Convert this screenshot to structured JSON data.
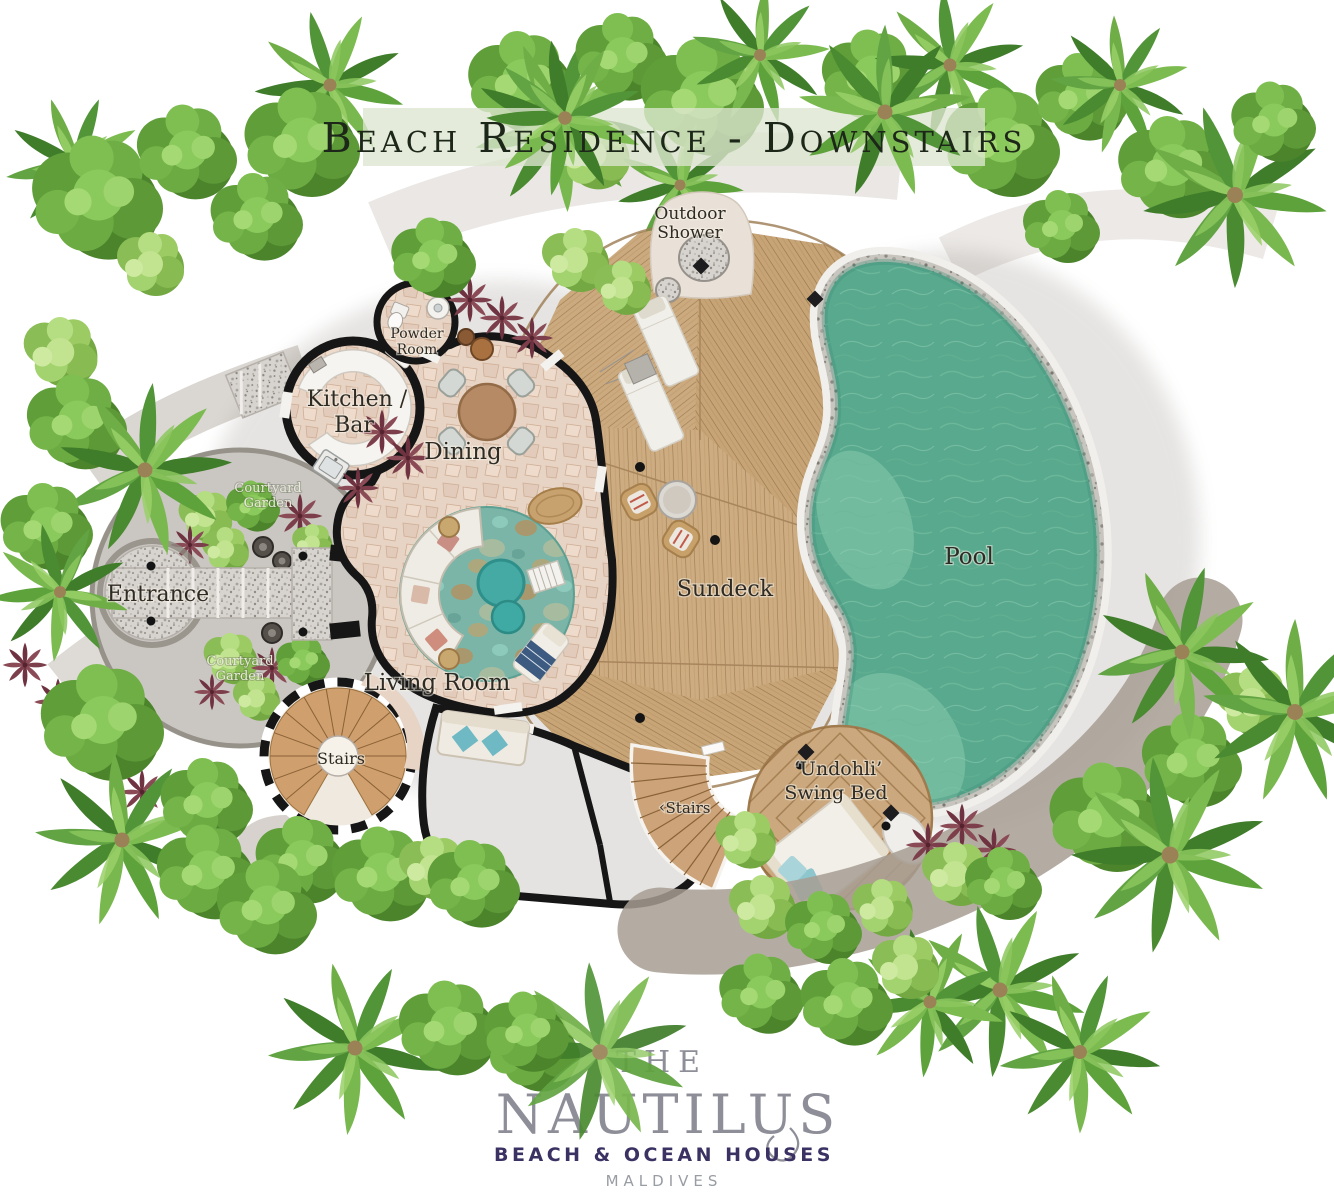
{
  "title": "Beach Residence - Downstairs",
  "labels": {
    "outdoor_shower_1": "Outdoor",
    "outdoor_shower_2": "Shower",
    "powder_room_1": "Powder",
    "powder_room_2": "Room",
    "kitchen_bar_1": "Kitchen /",
    "kitchen_bar_2": "Bar",
    "dining": "Dining",
    "courtyard_upper_1": "Courtyard",
    "courtyard_upper_2": "Garden",
    "entrance": "Entrance",
    "courtyard_lower_1": "Courtyard",
    "courtyard_lower_2": "Garden",
    "living_room": "Living Room",
    "stairs_spiral": "Stairs",
    "sundeck": "Sundeck",
    "pool": "Pool",
    "swing_bed_1": "‘Undohli’",
    "swing_bed_2": "Swing Bed",
    "stairs_lower_arrow": "‹",
    "stairs_lower": "Stairs"
  },
  "logo": {
    "the": "THE",
    "name": "NAUTILUS",
    "tagline": "BEACH & OCEAN HOUSES",
    "country": "MALDIVES"
  },
  "colors": {
    "pool_water": "#58a98e",
    "pool_shallow": "#7ec3a7",
    "deck_wood": "#c9a87e",
    "floor_stone": "#e8d4c5",
    "rug_teal": "#79b6a9",
    "walls": "#161616",
    "title_text": "#1d2719",
    "title_band": "#dde5cf",
    "granite": "#d6d2cd",
    "pebble_border": "#c6c2bc",
    "courtyard_path": "#cac6c1",
    "foliage_green": "#6aa83f",
    "red_plant": "#7c3e4a",
    "logo_gray": "#8e8e99",
    "logo_purple": "#3b3263",
    "logo_light_gray": "#989ca3"
  }
}
